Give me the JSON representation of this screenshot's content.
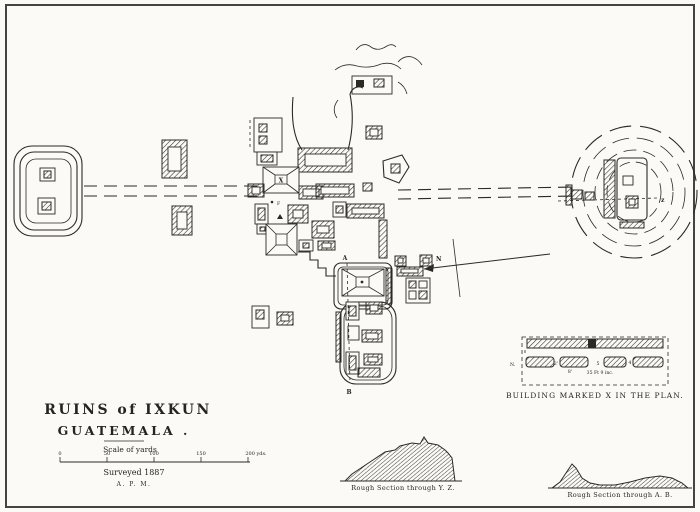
{
  "doc": {
    "title_line1": "RUINS of IXKUN",
    "title_line2": "GUATEMALA .",
    "scale": {
      "label": "Scale of yards",
      "ticks": [
        "0",
        "50",
        "100",
        "150",
        "200 yds."
      ],
      "surveyed": "Surveyed 1887",
      "initials": "A. P. M."
    },
    "plan_labels": {
      "north": "N",
      "point_a": "A",
      "point_b": "B",
      "point_z": "z",
      "building_x": "X",
      "stela_f": "F"
    },
    "detail": {
      "north": "N.",
      "gap1": "2'",
      "gap2": "5",
      "gap3": "4",
      "sub_dim": "8'",
      "dimension": "35 Ft 9 inc.",
      "caption": "BUILDING MARKED X IN THE PLAN."
    },
    "sections": {
      "yz_caption": "Rough Section through Y. Z.",
      "ab_caption": "Rough Section through A. B."
    }
  },
  "colors": {
    "ink": "#2b2a24",
    "paper": "#fbfaf6",
    "frame": "#45443f"
  }
}
